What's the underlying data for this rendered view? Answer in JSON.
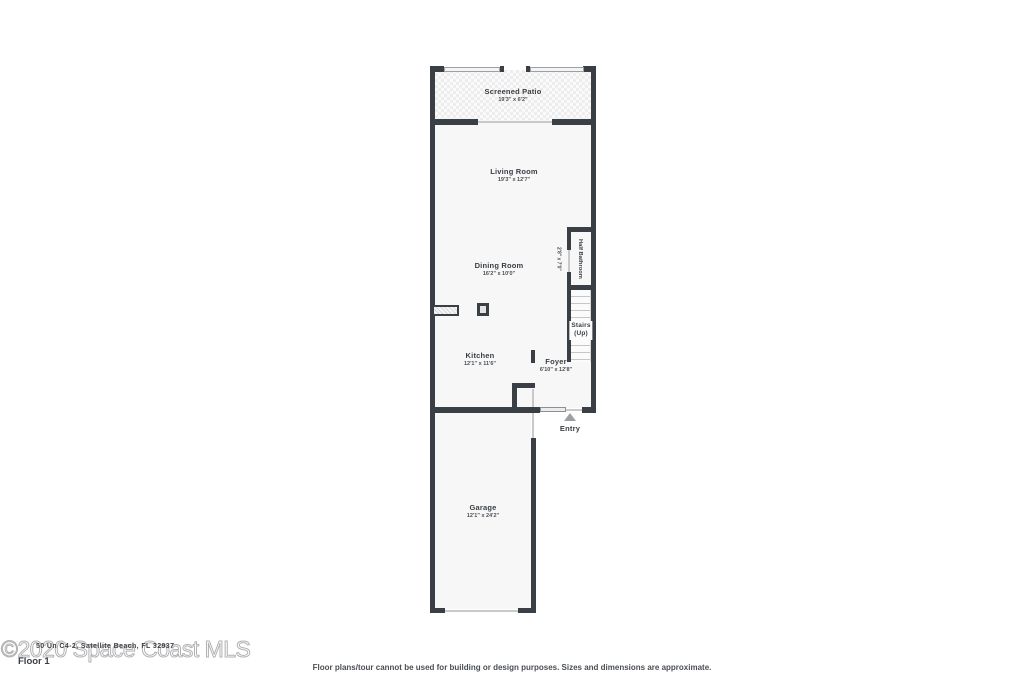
{
  "watermark": {
    "text": "©2020 Space Coast MLS"
  },
  "address_overlay": "50 Un C4-2, Satellite Beach, FL 32937",
  "floor_label": "Floor 1",
  "disclaimer": "Floor plans/tour cannot be used for building or design purposes. Sizes and dimensions are approximate.",
  "rooms": {
    "screened_patio": {
      "name": "Screened Patio",
      "dims": "19'3\" x 6'2\""
    },
    "living_room": {
      "name": "Living Room",
      "dims": "19'3\" x 12'7\""
    },
    "dining_room": {
      "name": "Dining Room",
      "dims": "16'2\" x 10'0\""
    },
    "kitchen": {
      "name": "Kitchen",
      "dims": "12'1\" x 11'6\""
    },
    "half_bathroom": {
      "name": "Half Bathroom",
      "dims": "2'8\" x 7'0\""
    },
    "stairs": {
      "name": "Stairs",
      "sub": "(Up)"
    },
    "foyer": {
      "name": "Foyer",
      "dims": "6'10\" x 12'8\""
    },
    "garage": {
      "name": "Garage",
      "dims": "12'1\" x 24'2\""
    },
    "entry": {
      "name": "Entry"
    }
  },
  "colors": {
    "wall": "#3a3f45",
    "room_fill": "#f7f7f8",
    "watermark": "#b2b2b2",
    "entry_marker": "#9aa0a5"
  }
}
